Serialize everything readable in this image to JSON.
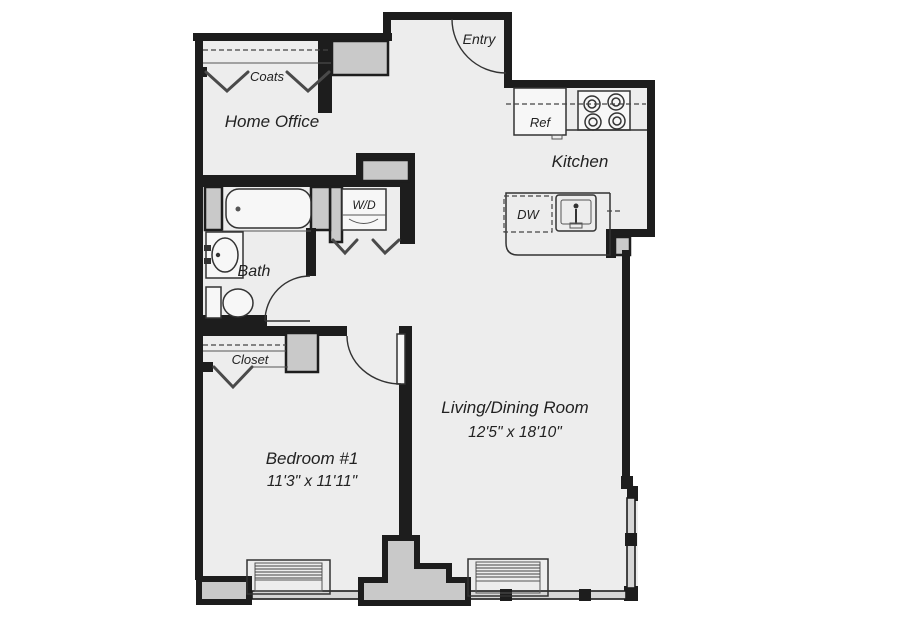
{
  "labels": {
    "coats": "Coats",
    "home_office": "Home Office",
    "entry": "Entry",
    "ref": "Ref",
    "kitchen": "Kitchen",
    "wd": "W/D",
    "bath": "Bath",
    "dw": "DW",
    "closet": "Closet",
    "bedroom": "Bedroom #1",
    "bedroom_dims": "11'3\" x 11'11\"",
    "living": "Living/Dining Room",
    "living_dims": "12'5\" x 18'10\""
  },
  "colors": {
    "wall": "#1d1d1d",
    "floor": "#ededed",
    "structural_gray": "#c9c9c9",
    "window_gray": "#d6d6d6",
    "background": "#ffffff",
    "text": "#222222"
  }
}
